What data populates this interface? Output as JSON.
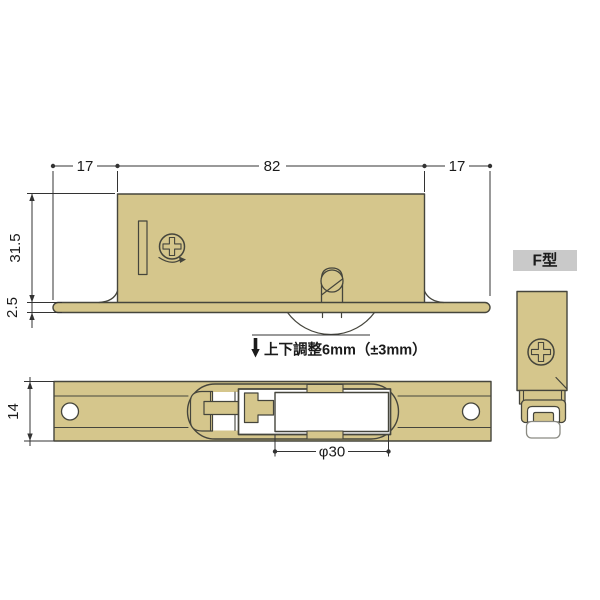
{
  "drawing": {
    "type_label": "F型",
    "annotation": "上下調整6mm（±3mm）",
    "dims": {
      "left_margin": "17",
      "body_width": "82",
      "right_margin": "17",
      "body_height": "31.5",
      "flange_thickness": "2.5",
      "plate_width": "14",
      "roller_diameter": "φ30"
    },
    "colors": {
      "part_fill": "#d5c68c",
      "outline": "#45453c",
      "dim_line": "#333333",
      "label_bg": "#c9c9c9",
      "roller_outline": "#8a8a82",
      "background": "#ffffff"
    }
  }
}
